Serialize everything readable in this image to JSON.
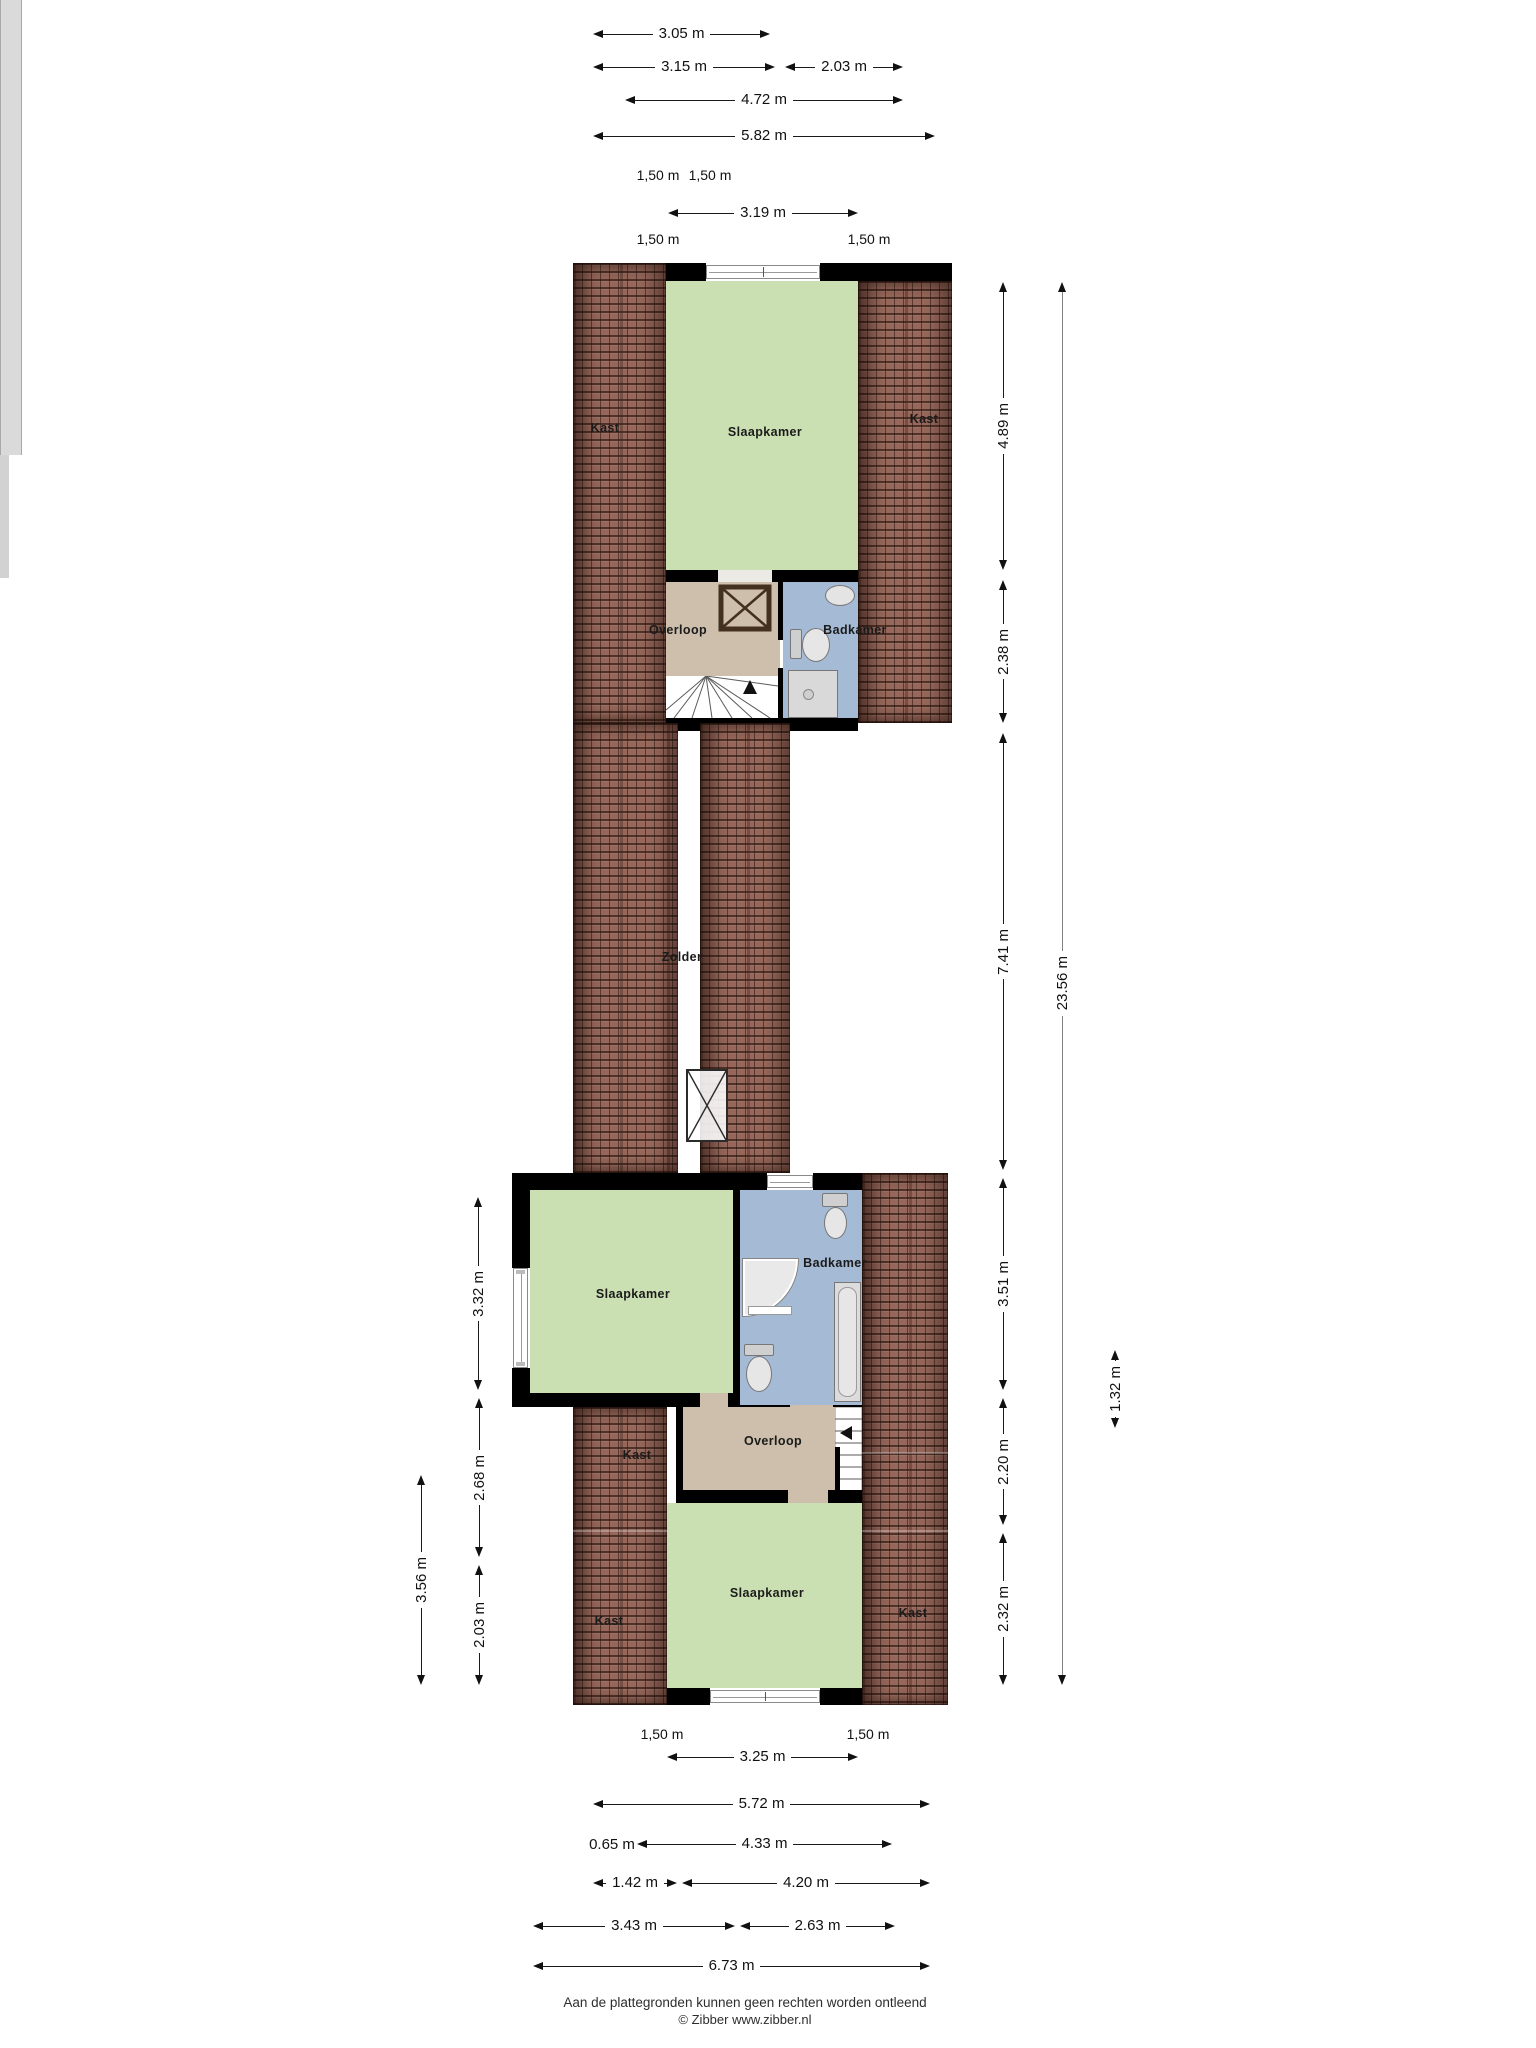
{
  "rooms": {
    "kast_top_left": "Kast",
    "slaapkamer_top": "Slaapkamer",
    "kast_top_right": "Kast",
    "overloop_top": "Overloop",
    "badkamer_top": "Badkamer",
    "zolder": "Zolder",
    "slaapkamer_mid": "Slaapkamer",
    "badkamer_low": "Badkamer",
    "kast_mid": "Kast",
    "overloop_low": "Overloop",
    "slaapkamer_low": "Slaapkamer",
    "kast_low_left": "Kast",
    "kast_low_right": "Kast"
  },
  "dims": {
    "top": {
      "w305": "3.05 m",
      "w315": "3.15 m",
      "w203": "2.03 m",
      "w472": "4.72 m",
      "w582": "5.82 m",
      "t150a": "1,50 m",
      "t150b": "1,50 m",
      "w319": "3.19 m",
      "t150c": "1,50 m",
      "t150d": "1,50 m"
    },
    "right": {
      "h489": "4.89 m",
      "h238": "2.38 m",
      "h741": "7.41 m",
      "h351": "3.51 m",
      "h220": "2.20 m",
      "h232": "2.32 m",
      "h2356": "23.56 m",
      "h132": "1.32 m"
    },
    "left": {
      "h332": "3.32 m",
      "h268": "2.68 m",
      "h203": "2.03 m",
      "h356": "3.56 m"
    },
    "bottom": {
      "t150a": "1,50 m",
      "t150b": "1,50 m",
      "w325": "3.25 m",
      "w572": "5.72 m",
      "w065": "0.65 m",
      "w433": "4.33 m",
      "w142": "1.42 m",
      "w420": "4.20 m",
      "w343": "3.43 m",
      "w263": "2.63 m",
      "w673": "6.73 m"
    }
  },
  "footer": {
    "line1": "Aan de plattegronden kunnen geen rechten worden ontleend",
    "line2": "© Zibber www.zibber.nl"
  },
  "colors": {
    "room_green": "#cbe0b2",
    "room_blue": "#a5bad4",
    "room_beige": "#cdbfab",
    "roof_brick": "#96675a",
    "wall": "#000000",
    "corridor": "#dadada"
  }
}
